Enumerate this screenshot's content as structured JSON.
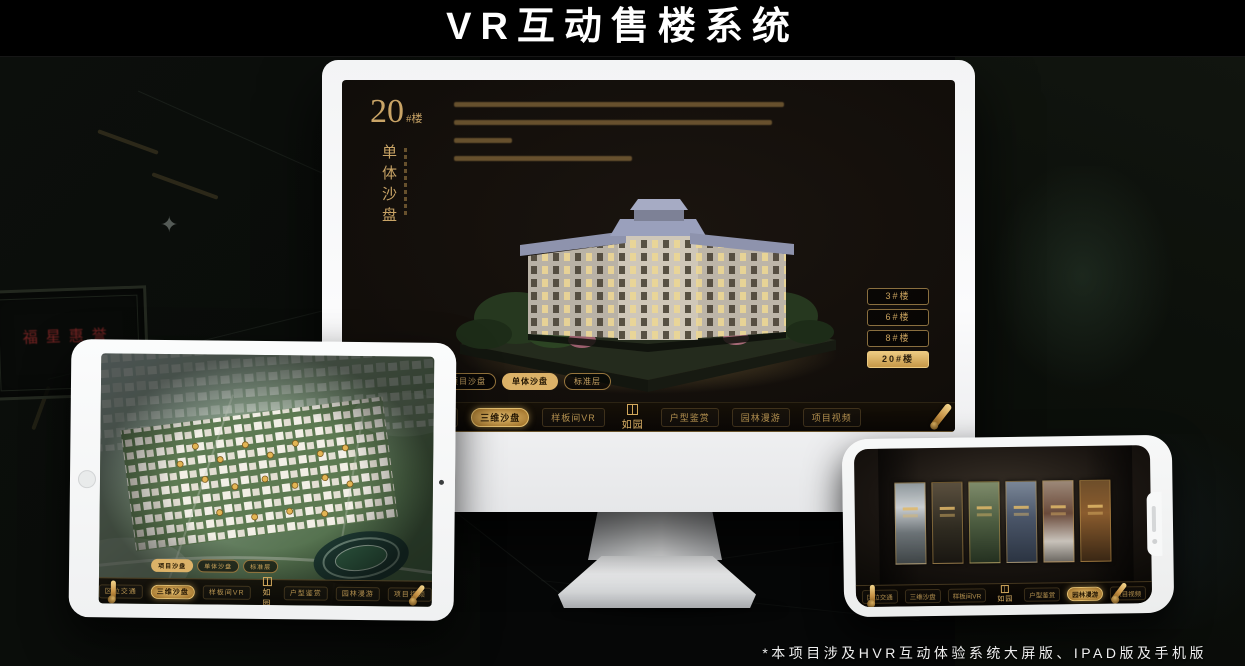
{
  "page": {
    "title": "VR互动售楼系统",
    "footnote": "*本项目涉及HVR互动体验系统大屏版、IPAD版及手机版"
  },
  "colors": {
    "gold": "#C9A464",
    "gold_active": "#DCB268",
    "screen_dark": "#0E0B08"
  },
  "background": {
    "plaque_text": "福星惠誉"
  },
  "monitor": {
    "screen": {
      "heading": {
        "number": "20",
        "suffix": "#楼",
        "title_vertical": "单体沙盘"
      },
      "floor_buttons": [
        {
          "label": "3#楼",
          "active": false
        },
        {
          "label": "6#楼",
          "active": false
        },
        {
          "label": "8#楼",
          "active": false
        },
        {
          "label": "20#楼",
          "active": true
        }
      ],
      "tabs": [
        {
          "label": "项目沙盘",
          "active": false
        },
        {
          "label": "单体沙盘",
          "active": true
        },
        {
          "label": "标准层",
          "active": false
        }
      ],
      "nav": {
        "logo": "如园",
        "items": [
          {
            "label": "区位交通",
            "active": false
          },
          {
            "label": "三维沙盘",
            "active": true
          },
          {
            "label": "样板间VR",
            "active": false
          },
          {
            "label": "户型鉴赏",
            "active": false
          },
          {
            "label": "园林漫游",
            "active": false
          },
          {
            "label": "项目视频",
            "active": false
          }
        ]
      }
    }
  },
  "tablet": {
    "tabs": [
      {
        "label": "项目沙盘",
        "active": true
      },
      {
        "label": "单体沙盘",
        "active": false
      },
      {
        "label": "标准层",
        "active": false
      }
    ],
    "nav": {
      "logo": "如园",
      "items": [
        {
          "label": "区位交通",
          "active": false
        },
        {
          "label": "三维沙盘",
          "active": true
        },
        {
          "label": "样板间VR",
          "active": false
        },
        {
          "label": "户型鉴赏",
          "active": false
        },
        {
          "label": "园林漫游",
          "active": false
        },
        {
          "label": "项目视频",
          "active": false
        }
      ]
    }
  },
  "phone": {
    "nav": {
      "logo": "如园",
      "items": [
        {
          "label": "区位交通",
          "active": false
        },
        {
          "label": "三维沙盘",
          "active": false
        },
        {
          "label": "样板间VR",
          "active": false
        },
        {
          "label": "户型鉴赏",
          "active": false
        },
        {
          "label": "园林漫游",
          "active": true
        },
        {
          "label": "项目视频",
          "active": false
        }
      ]
    },
    "gallery": [
      "courtyard",
      "pavilion",
      "garden",
      "tower",
      "autumn",
      "interior"
    ]
  }
}
